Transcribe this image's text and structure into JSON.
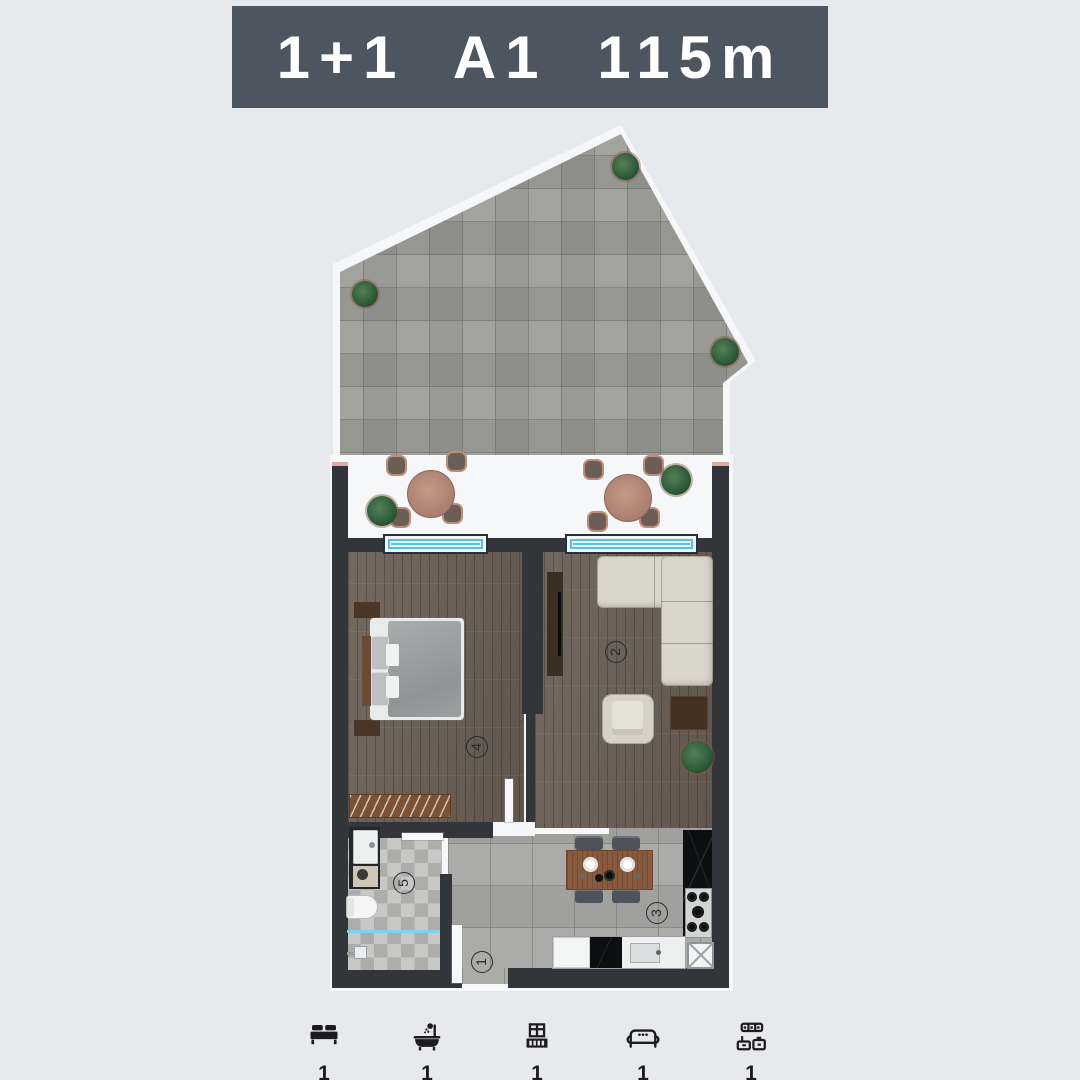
{
  "header": {
    "title": "1+1 A1 115m"
  },
  "plan": {
    "room_labels": [
      {
        "number": "1"
      },
      {
        "number": "2"
      },
      {
        "number": "3"
      },
      {
        "number": "4"
      },
      {
        "number": "5"
      }
    ]
  },
  "legend": {
    "items": [
      {
        "icon": "bed-icon",
        "count": "1"
      },
      {
        "icon": "bathtub-icon",
        "count": "1"
      },
      {
        "icon": "balcony-icon",
        "count": "1"
      },
      {
        "icon": "sofa-icon",
        "count": "1"
      },
      {
        "icon": "kitchen-icon",
        "count": "1"
      }
    ]
  },
  "colors": {
    "background": "#e7e9ed",
    "banner_bg": "#4d5560",
    "banner_text": "#ffffff",
    "wall": "#32363b",
    "window_glass": "#54bfe8",
    "terrace_tile": "#9b9b98",
    "kitchen_tile": "#a7a7a4",
    "wood_floor": "#6b6056",
    "counter_marble": "#0d0e10",
    "sofa_cream": "#dcd6ca",
    "icon_dark": "#1c1c1e"
  }
}
